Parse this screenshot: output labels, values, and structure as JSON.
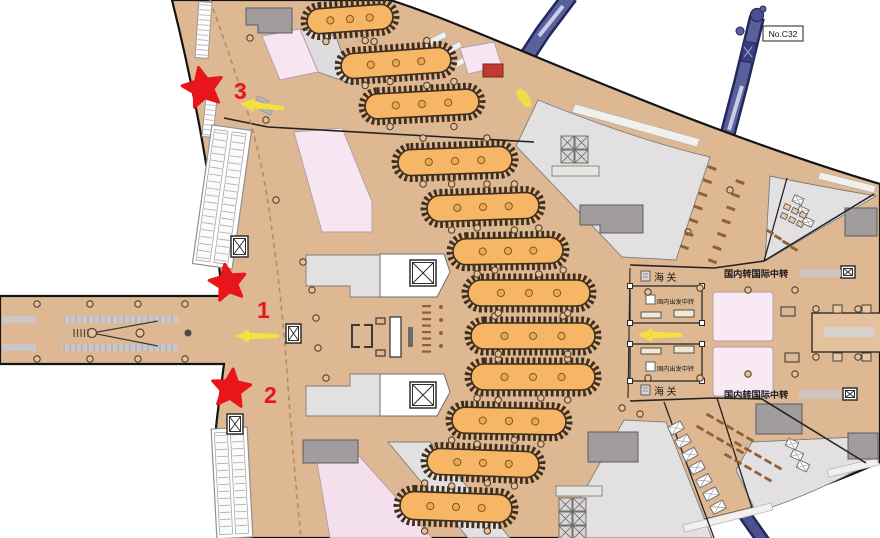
{
  "labels": {
    "gate_no": "No.C32",
    "customs": "海关",
    "intl_transfer": "国内转国际中转",
    "domestic_transfer": "国内出发中转"
  },
  "markers": [
    {
      "label": "1"
    },
    {
      "label": "2"
    },
    {
      "label": "3"
    }
  ],
  "colors": {
    "floor_tan": "#DDB892",
    "carousel_belt": "#F6B666",
    "carousel_ring": "#3F2F1C",
    "marker_star_red": "#E8151B",
    "arrow_yellow": "#F2E33D",
    "jet_bridge_blue": "#59609A",
    "transfer_zone_pink": "#F8E9F3",
    "landside_gray": "#E3E0E1",
    "block_gray": "#A19D9F"
  }
}
